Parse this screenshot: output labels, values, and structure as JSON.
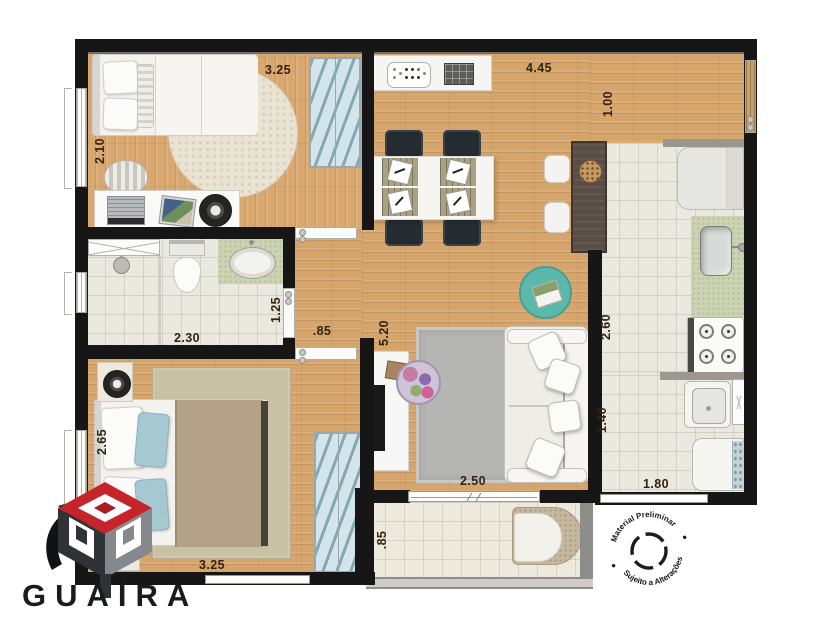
{
  "brand": {
    "name": "GUAÍRA"
  },
  "stamp": {
    "arc_top": "Material Preliminar",
    "arc_bottom": "Sujeito a Alterações"
  },
  "dims": {
    "bedroom1_w": "3.25",
    "bedroom1_d": "2.10",
    "bath_w": "2.30",
    "bath_d": "1.25",
    "hall_w": ".85",
    "living_w": "4.45",
    "entry_w": "1.00",
    "living_d": "5.20",
    "living_door": "2.50",
    "kitchen_d": "2.60",
    "laundry_d": "1.40",
    "laundry_w": "1.80",
    "bedroom2_d": "2.65",
    "bedroom2_w": "3.25",
    "balcony_d": ".85"
  },
  "colors": {
    "wall": "#161616",
    "wood_floor": "#d5a56c",
    "tile_floor": "#eae8df",
    "counter_green": "#ccd3b3",
    "wardrobe_blue": "#d3e4ea",
    "rug_gray": "#b5b5b3",
    "pouf_teal": "#5bb9ac",
    "logo_red": "#c5242b",
    "dim_text": "#33240f"
  }
}
